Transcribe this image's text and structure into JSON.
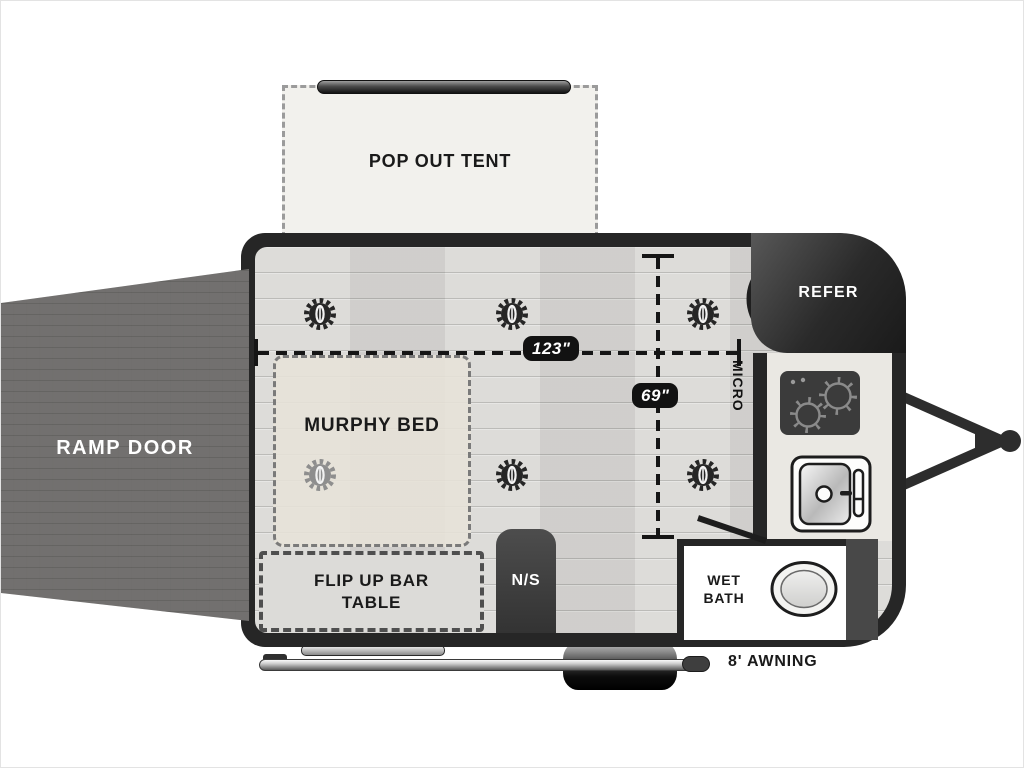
{
  "rooms": {
    "pop_out_tent": {
      "label": "POP OUT TENT"
    },
    "ramp_door": {
      "label": "RAMP DOOR"
    },
    "murphy_bed": {
      "label": "MURPHY BED"
    },
    "flip_table": {
      "label": "FLIP UP BAR TABLE"
    },
    "nightstand": {
      "label": "N/S"
    },
    "wet_bath": {
      "label": "WET BATH"
    },
    "refrigerator": {
      "label": "REFER"
    },
    "microwave": {
      "label": "MICRO"
    }
  },
  "exterior": {
    "awning_label": "8' AWNING"
  },
  "dimensions": {
    "width_label": "123\"",
    "depth_label": "69\""
  },
  "icons": {
    "ceiling_light": "gear-light-icon",
    "vent_fan": "fan-icon",
    "stove": "two-burner-cooktop-icon",
    "sink": "sink-icon",
    "toilet": "toilet-icon",
    "wheel": "wheel-icon",
    "hitch": "tongue-hitch-icon",
    "awning_rod": "awning-rail-icon",
    "entry_door": "door-swing-icon"
  },
  "colors": {
    "wall": "#262626",
    "floor": "#d9d8d5",
    "murphy_bed_fill": "#e7e3da",
    "tent_fill": "#f2f1ed",
    "ramp_fill": "#575553",
    "counter_fill": "#eae8e3",
    "dim_label_bg": "#121212",
    "text": "#1a1a1a"
  }
}
